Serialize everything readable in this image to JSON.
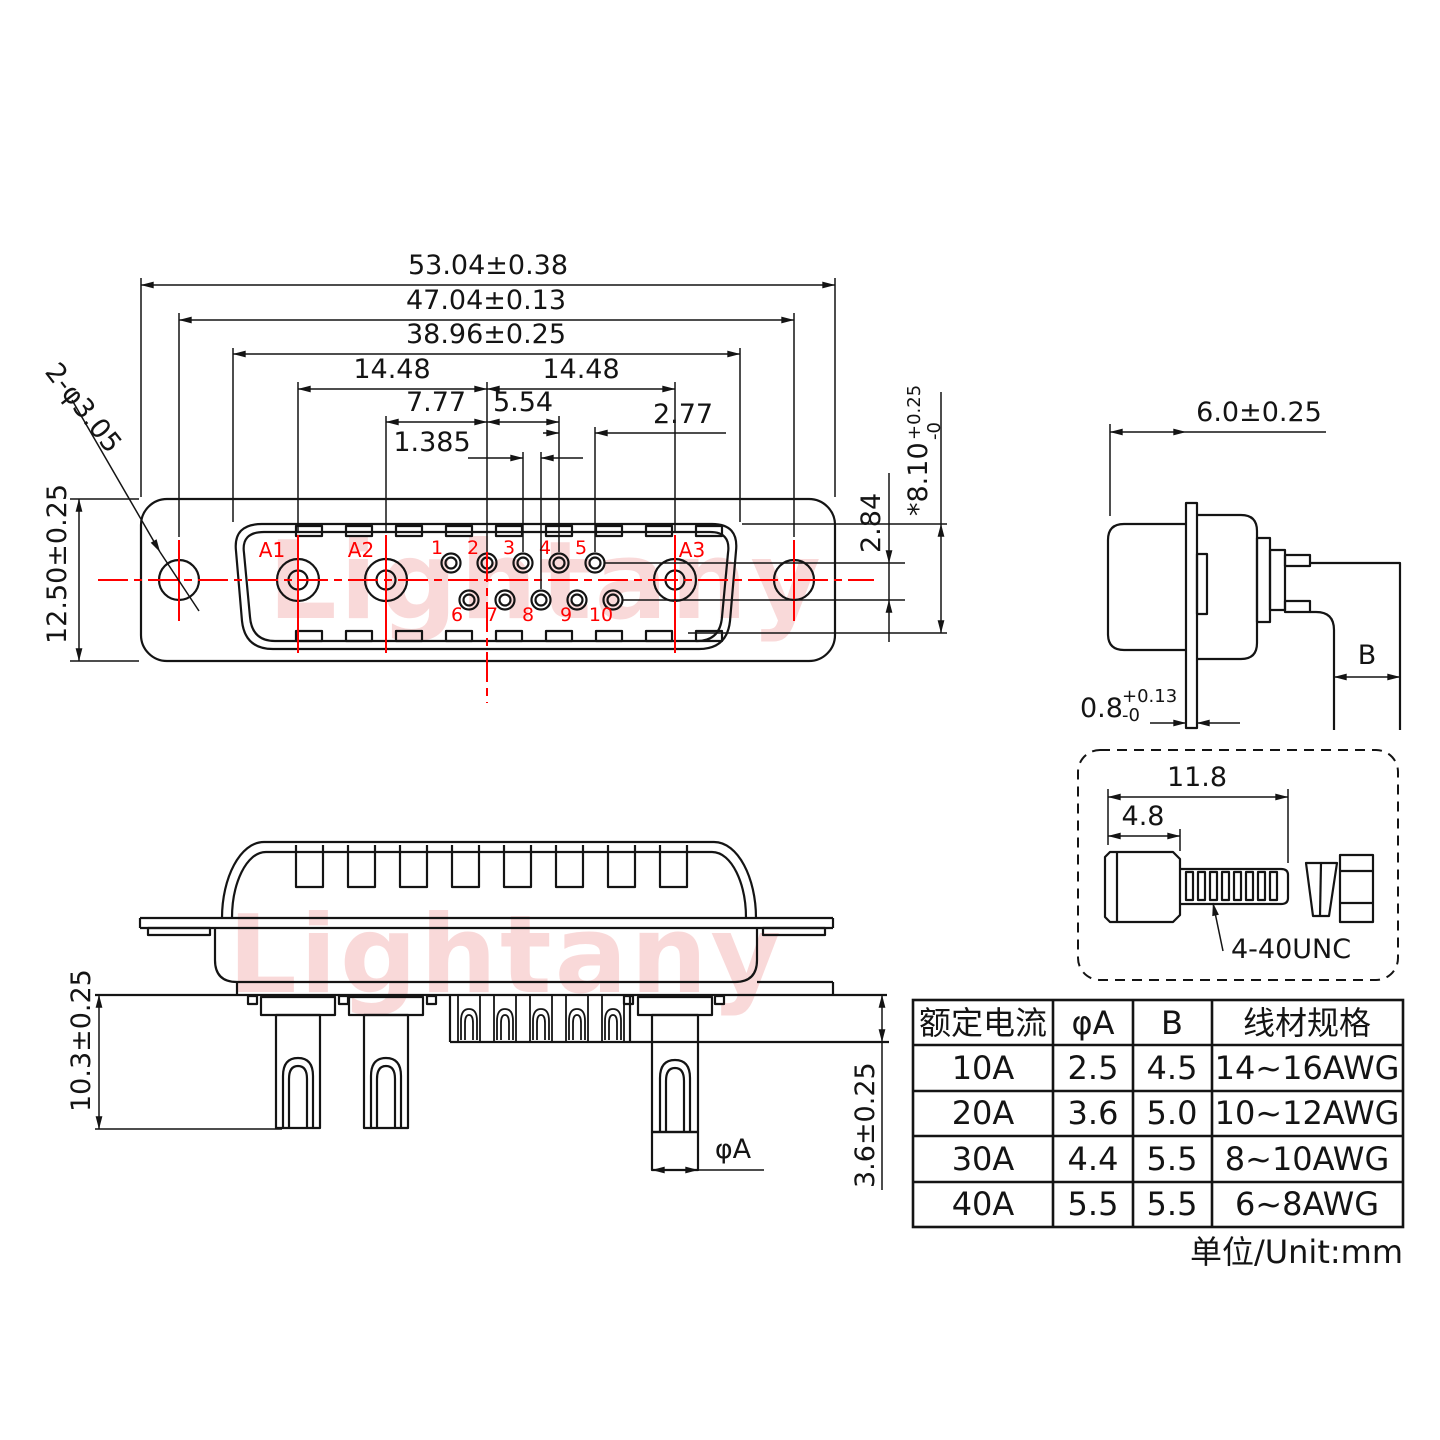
{
  "colors": {
    "line": "#141414",
    "accent_red": "#ff0000",
    "watermark_pink": "#f6c0c0"
  },
  "watermark": {
    "text": "Lightany"
  },
  "front_view": {
    "dims": {
      "total_width": "53.04±0.38",
      "mount_hole_span": "47.04±0.13",
      "shell_width": "38.96±0.25",
      "a1_to_center": "14.48",
      "center_to_a3": "14.48",
      "a2_to_center": "7.77",
      "center_to_pin4": "5.54",
      "pin_pitch": "2.77",
      "half_pitch": "1.385",
      "row_gap": "2.84",
      "shell_height": "*8.10",
      "shell_height_tol_plus": "+0.25",
      "shell_height_tol_minus": "-0",
      "flange_height": "12.50±0.25",
      "mount_holes": "2-φ3.05"
    },
    "power_pin_labels": [
      "A1",
      "A2",
      "A3"
    ],
    "signal_pin_labels": [
      "1",
      "2",
      "3",
      "4",
      "5",
      "6",
      "7",
      "8",
      "9",
      "10"
    ]
  },
  "side_view": {
    "dims": {
      "shell_depth": "6.0±0.25",
      "flange_thickness": "0.8",
      "flange_thickness_tol_plus": "+0.13",
      "flange_thickness_tol_minus": "-0",
      "wire_entry_width": "B"
    }
  },
  "screw_detail": {
    "dims": {
      "total_length": "11.8",
      "head_length": "4.8"
    },
    "thread_spec": "4-40UNC"
  },
  "bottom_view": {
    "dims": {
      "pin_length": "10.3±0.25",
      "tail_length": "3.6±0.25",
      "pin_diameter": "φA"
    }
  },
  "spec_table": {
    "headers": [
      "额定电流",
      "φA",
      "B",
      "线材规格"
    ],
    "rows": [
      [
        "10A",
        "2.5",
        "4.5",
        "14~16AWG"
      ],
      [
        "20A",
        "3.6",
        "5.0",
        "10~12AWG"
      ],
      [
        "30A",
        "4.4",
        "5.5",
        "8~10AWG"
      ],
      [
        "40A",
        "5.5",
        "5.5",
        "6~8AWG"
      ]
    ]
  },
  "unit_note": "单位/Unit:mm"
}
